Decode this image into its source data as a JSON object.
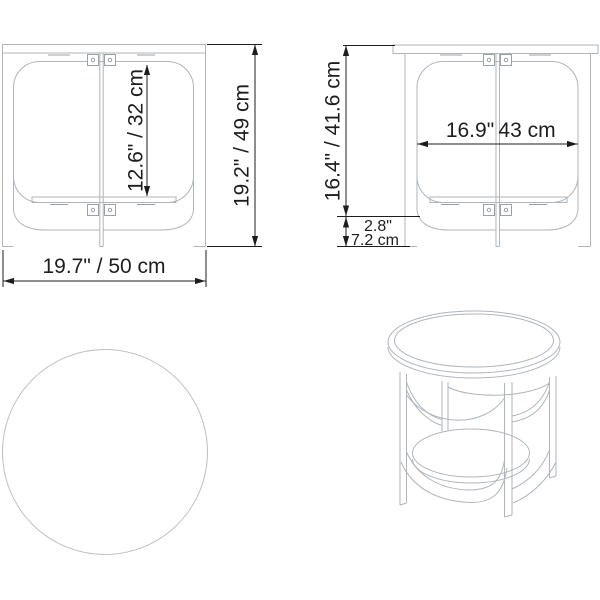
{
  "front_view": {
    "opening_height": "12.6\" / 32 cm",
    "overall_height": "19.2\" / 49 cm",
    "overall_width": "19.7\" / 50 cm"
  },
  "side_view": {
    "top_section_height": "16.4\" / 41.6 cm",
    "opening_width_in": "16.9\"",
    "opening_width_cm": "43 cm",
    "base_height_in": "2.8\"",
    "base_height_cm": "7.2 cm"
  },
  "colors": {
    "outline": "#aeb5bb",
    "outline_faint": "#bcc2c7",
    "hidden_edge": "#98a0a6",
    "dimension": "#1d1d1f",
    "background": "#ffffff"
  }
}
